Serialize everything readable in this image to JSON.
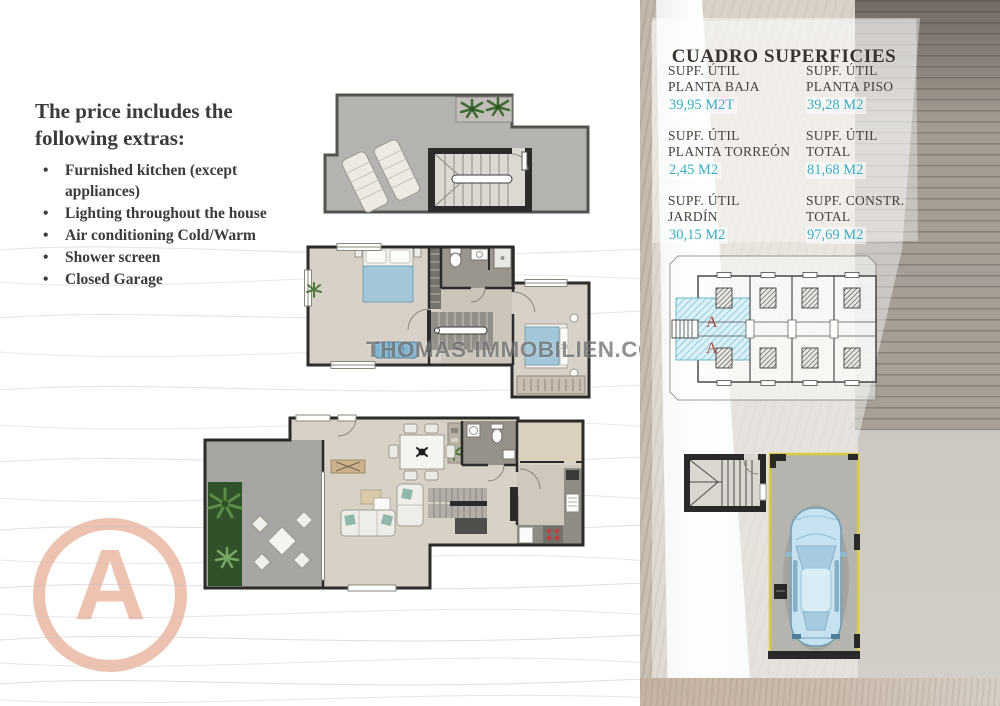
{
  "extras": {
    "title": "The price includes the following extras:",
    "bullet": "•",
    "items": [
      "Furnished kitchen (except appliances)",
      "Lighting throughout the house",
      "Air conditioning Cold/Warm",
      "Shower screen",
      "Closed Garage"
    ]
  },
  "watermark": {
    "text": "THOMAS-IMMOBILIEN.COM"
  },
  "surfaces": {
    "title": "CUADRO SUPERFICIES",
    "cells": [
      {
        "l1": "SUPF. ÚTIL",
        "l2": "PLANTA BAJA",
        "value": "39,95 M2T"
      },
      {
        "l1": "SUPF. ÚTIL",
        "l2": "PLANTA PISO",
        "value": "39,28 M2"
      },
      {
        "l1": "SUPF. ÚTIL",
        "l2": "PLANTA TORREÓN",
        "value": "2,45 M2"
      },
      {
        "l1": "SUPF. ÚTIL",
        "l2": "TOTAL",
        "value": "81,68 M2"
      },
      {
        "l1": "SUPF. ÚTIL",
        "l2": "JARDÍN",
        "value": "30,15 M2"
      },
      {
        "l1": "SUPF. CONSTR.",
        "l2": "TOTAL",
        "value": "97,69 M2"
      }
    ]
  },
  "siteplan": {
    "unit_label": "A"
  },
  "badge": {
    "letter": "A"
  },
  "colors": {
    "accent_cyan": "#35aec6",
    "label_brown": "#46403a",
    "salmon": "#eec2b0",
    "site_unit_red": "#a84a40",
    "garage_outline_yellow": "#d9ca3f",
    "car_blue": "#c6e1f0",
    "grass_green": "#31512b",
    "wall_dark": "#2c2b29"
  }
}
